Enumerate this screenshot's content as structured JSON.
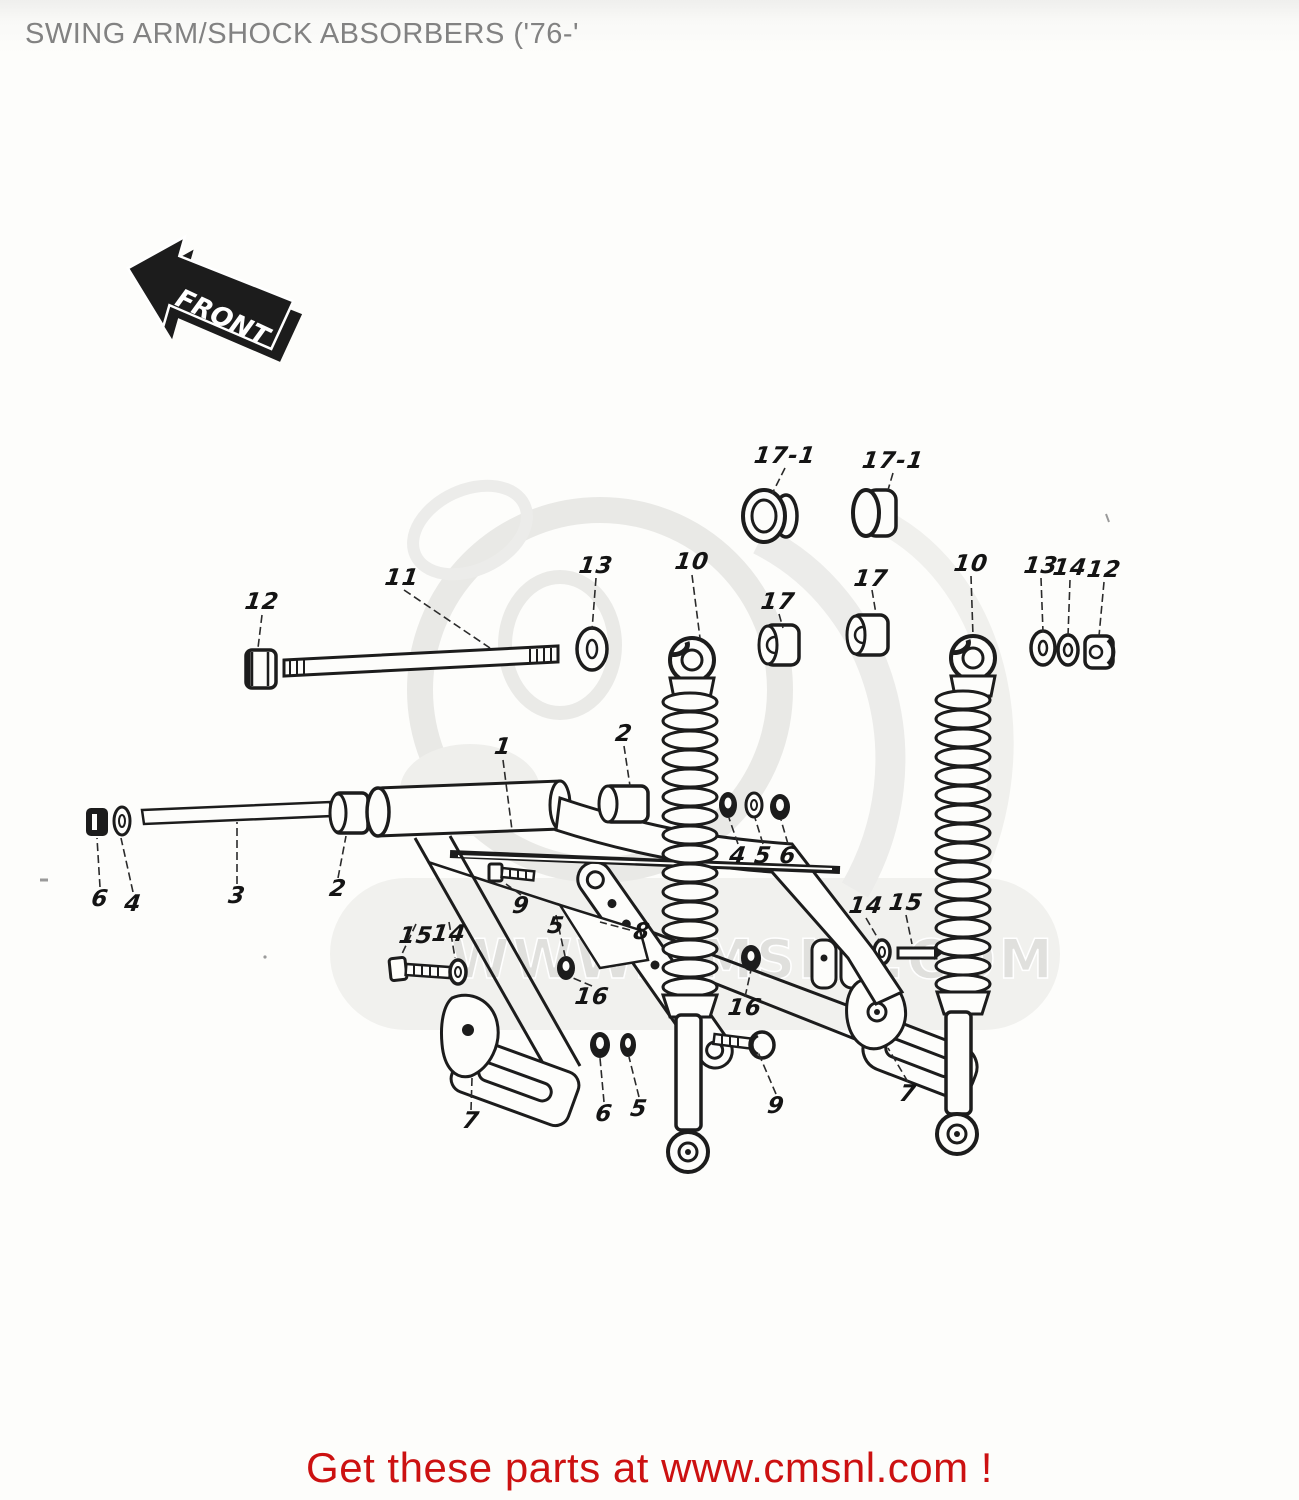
{
  "page": {
    "title": "SWING ARM/SHOCK ABSORBERS ('76-'"
  },
  "front_arrow": {
    "label": "FRONT"
  },
  "watermark": {
    "text": "WWW.CMSNL.COM"
  },
  "footer": {
    "text": "Get these parts at www.cmsnl.com !",
    "color": "#cc1111"
  },
  "colors": {
    "title_gray": "#828282",
    "line_black": "#1c1c1c",
    "watermark_gray": "#e6e6e3",
    "footer_red": "#cc1111"
  },
  "diagram": {
    "description": "Exploded parts diagram: swing arm and twin rear shock absorbers",
    "labels": [
      {
        "text": "17-1",
        "x": 785,
        "y": 456
      },
      {
        "text": "17-1",
        "x": 893,
        "y": 461
      },
      {
        "text": "11",
        "x": 402,
        "y": 578
      },
      {
        "text": "12",
        "x": 262,
        "y": 602
      },
      {
        "text": "13",
        "x": 596,
        "y": 566
      },
      {
        "text": "10",
        "x": 692,
        "y": 562
      },
      {
        "text": "17",
        "x": 778,
        "y": 602
      },
      {
        "text": "17",
        "x": 871,
        "y": 579
      },
      {
        "text": "10",
        "x": 971,
        "y": 564
      },
      {
        "text": "13",
        "x": 1041,
        "y": 566
      },
      {
        "text": "14",
        "x": 1070,
        "y": 568
      },
      {
        "text": "12",
        "x": 1104,
        "y": 570
      },
      {
        "text": "1",
        "x": 503,
        "y": 747
      },
      {
        "text": "2",
        "x": 624,
        "y": 734
      },
      {
        "text": "2",
        "x": 338,
        "y": 889
      },
      {
        "text": "3",
        "x": 237,
        "y": 896
      },
      {
        "text": "4",
        "x": 133,
        "y": 904
      },
      {
        "text": "6",
        "x": 100,
        "y": 899
      },
      {
        "text": "4",
        "x": 738,
        "y": 856
      },
      {
        "text": "5",
        "x": 763,
        "y": 856
      },
      {
        "text": "6",
        "x": 788,
        "y": 856
      },
      {
        "text": "9",
        "x": 521,
        "y": 906
      },
      {
        "text": "5",
        "x": 556,
        "y": 926
      },
      {
        "text": "8",
        "x": 642,
        "y": 932
      },
      {
        "text": "15",
        "x": 416,
        "y": 936
      },
      {
        "text": "14",
        "x": 449,
        "y": 934
      },
      {
        "text": "16",
        "x": 592,
        "y": 997
      },
      {
        "text": "16",
        "x": 745,
        "y": 1008
      },
      {
        "text": "14",
        "x": 866,
        "y": 906
      },
      {
        "text": "15",
        "x": 906,
        "y": 903
      },
      {
        "text": "6",
        "x": 604,
        "y": 1114
      },
      {
        "text": "5",
        "x": 639,
        "y": 1109
      },
      {
        "text": "9",
        "x": 776,
        "y": 1106
      },
      {
        "text": "7",
        "x": 471,
        "y": 1121
      },
      {
        "text": "7",
        "x": 908,
        "y": 1094
      }
    ]
  }
}
